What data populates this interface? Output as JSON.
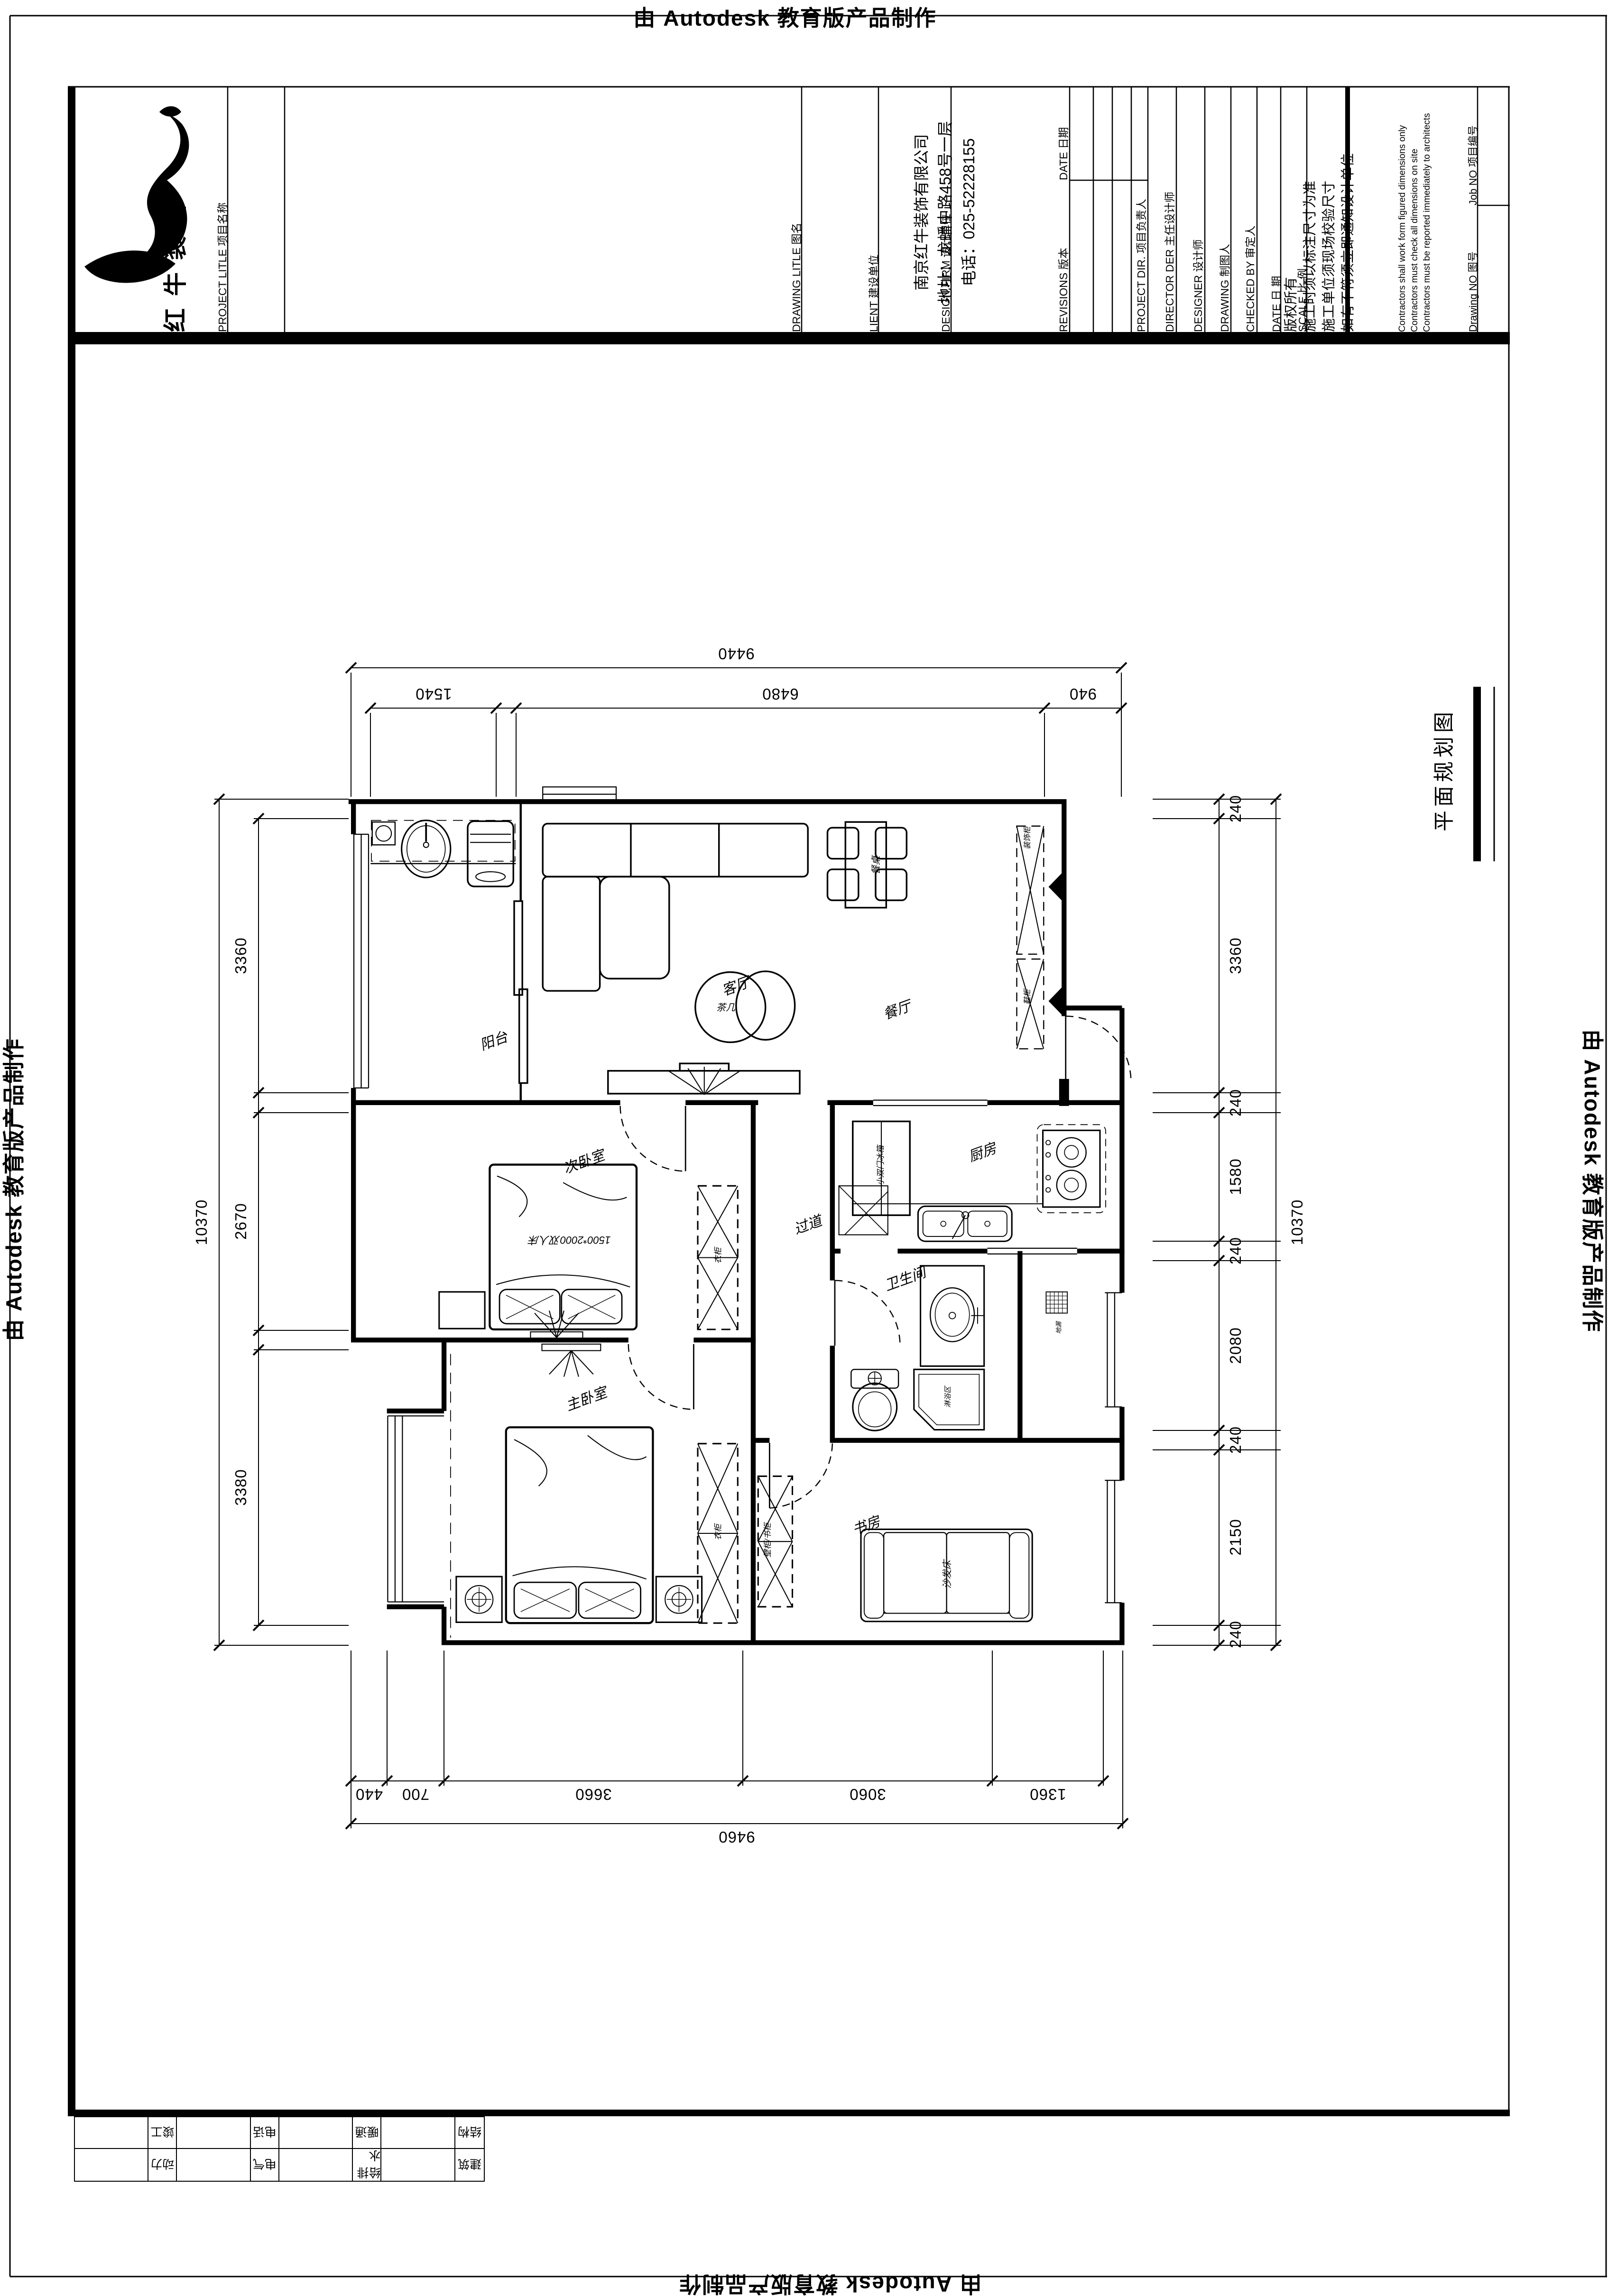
{
  "watermark": {
    "text": "由 Autodesk 教育版产品制作"
  },
  "title_block": {
    "logo_text": "红牛装饰",
    "project_title_label": "PROJECT LITLE  项目名称",
    "drawing_title_label": "DRAWING LITLE  图名",
    "client_label": "LIENT  建设单位",
    "design_firm_label": "DESIGN FIRM  设计单位",
    "firm_name": "南京红牛装饰有限公司",
    "firm_address": "地址：龙蟠中路458号一层",
    "firm_phone": "电话：025-52228155",
    "revisions_label": "REVISIONS  版本",
    "revision_date_label": "DATE  日期",
    "project_dir_label": "PROJECT DIR.  项目负责人",
    "director_label": "DIRECTOR DER 主任设计师",
    "designer_label": "DESIGNER  设计师",
    "drawing_by_label": "DRAWING  制图人",
    "checked_by_label": "CHECKED BY  审定人",
    "date_label": "DATE  日  期",
    "scale_label": "SCALE  比  例",
    "notes_line1": "版权所有",
    "notes_line2": "施工时须以标注尺寸为准",
    "notes_line3": "施工单位须现场校验尺寸",
    "notes_line4": "如有不符须立即通知设计单位",
    "notes_en1": "Contractors shall  work  form figured  dimensions  only",
    "notes_en2": "Contractors  must  check  all  dimensions  on  site",
    "notes_en3": "Contractors  must  be  reported  immediately  to  architects",
    "job_no_label": "Job NO  项目编号",
    "drawing_no_label": "Drawing NO  图号"
  },
  "drawing_title": "平面规划图",
  "rooms": {
    "balcony": "阳台",
    "living": "客厅",
    "dining": "餐厅",
    "kitchen": "厨房",
    "corridor": "过道",
    "bedroom2": "次卧室",
    "master": "主卧室",
    "bathroom": "卫生间",
    "study": "书房"
  },
  "furniture": {
    "tea_table": "茶几",
    "dining_table": "餐桌",
    "deco_cabinet": "装饰柜",
    "shoe_cabinet": "鞋柜",
    "fridge": "小双门冰箱",
    "bed2": "1500*2000双人床",
    "wardrobe": "衣柜",
    "wall_bookcase": "壁柜/书柜",
    "sofa_bed": "沙发床",
    "shower": "淋浴区",
    "floor_drain": "地漏"
  },
  "dimensions": {
    "top": {
      "overall": "9440",
      "segments": [
        "1540",
        "6480",
        "940"
      ]
    },
    "bottom": {
      "overall": "9460",
      "segments": [
        "440",
        "700",
        "3660",
        "3060",
        "1360"
      ]
    },
    "left": {
      "overall": "10370",
      "segments": [
        "3360",
        "2670",
        "3380"
      ]
    },
    "right": {
      "overall": "10370",
      "segments": [
        "240",
        "3360",
        "240",
        "1580",
        "240",
        "2080",
        "240",
        "2150",
        "240"
      ]
    }
  },
  "discipline_table": {
    "row1": [
      "建筑",
      "给排水",
      "电气",
      "动力"
    ],
    "row2": [
      "结构",
      "暖通",
      "电话",
      "竣工"
    ]
  }
}
